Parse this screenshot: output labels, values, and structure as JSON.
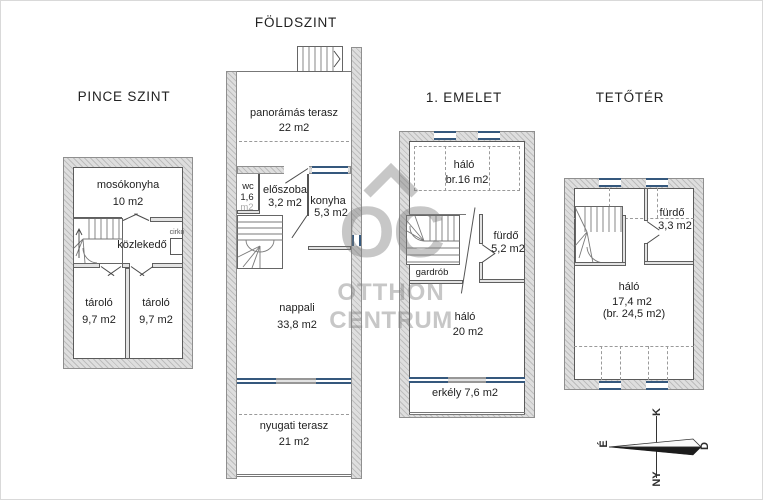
{
  "titles": {
    "pince": "PINCE SZINT",
    "foldszint": "FÖLDSZINT",
    "emelet": "1. EMELET",
    "tetoter": "TETŐTÉR"
  },
  "pince": {
    "mosokonyha": "mosókonyha",
    "mosokonyha_area": "10 m2",
    "kozlekedo": "közlekedő",
    "cirko": "cirkó",
    "tarolo_left": "tároló",
    "tarolo_left_area": "9,7 m2",
    "tarolo_right": "tároló",
    "tarolo_right_area": "9,7 m2"
  },
  "foldszint": {
    "terasz_felso": "panorámás terasz",
    "terasz_felso_area": "22 m2",
    "wc": "wc",
    "wc_area": "1,6",
    "wc_unit": "m2",
    "eloszoba": "előszoba",
    "eloszoba_area": "3,2 m2",
    "konyha": "konyha",
    "konyha_area": "5,3 m2",
    "nappali": "nappali",
    "nappali_area": "33,8 m2",
    "terasz_also": "nyugati terasz",
    "terasz_also_area": "21 m2"
  },
  "emelet": {
    "halo_felso": "háló",
    "halo_felso_area": "br.16 m2",
    "gardrob": "gardrób",
    "furdo": "fürdő",
    "furdo_area": "5,2 m2",
    "halo_also": "háló",
    "halo_also_area": "20 m2",
    "erkely": "erkély 7,6 m2"
  },
  "tetoter": {
    "furdo": "fürdő",
    "furdo_area": "3,3 m2",
    "halo": "háló",
    "halo_area": "17,4 m2",
    "halo_area_br": "(br. 24,5 m2)"
  },
  "compass": {
    "north": "É",
    "east": "K",
    "south": "D",
    "west": "NY"
  },
  "watermark": {
    "line1": "OC",
    "line2": "OTTHON",
    "line3": "CENTRUM"
  },
  "colors": {
    "window": "#35587d",
    "wall_hatch": "#cfcfcf",
    "text": "#222222",
    "watermark": "#c4c4c4"
  }
}
